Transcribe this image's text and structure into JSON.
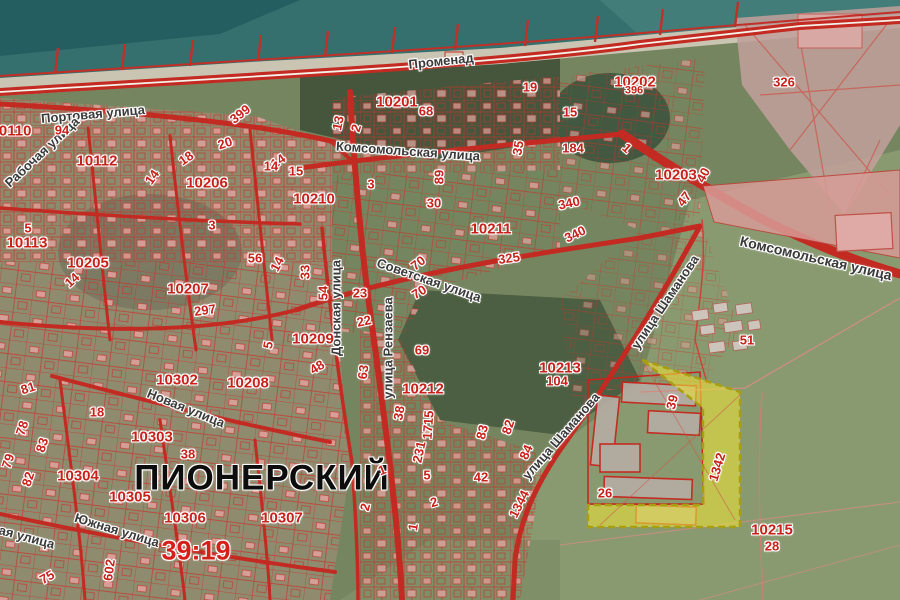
{
  "map": {
    "place": "ПИОНЕРСКИЙ",
    "district": "39:19",
    "place_pos": {
      "x": 262,
      "y": 478
    },
    "district_pos": {
      "x": 196,
      "y": 551
    },
    "colors": {
      "sea": "#35706e",
      "sand": "#cac4b2",
      "land": "#75855f",
      "parcel_lines": "#c8352c",
      "number_text": "#c8201a",
      "street_text": "#3a3a3a",
      "highlight_fill": "#e6df3d",
      "highlight_border": "#a89f10"
    }
  },
  "selected_parcel": {
    "label": "1342",
    "x": 717,
    "y": 467,
    "r": -73
  },
  "streets": [
    {
      "t": "Променад",
      "x": 441,
      "y": 61,
      "r": -6
    },
    {
      "t": "Портовая улица",
      "x": 93,
      "y": 114,
      "r": -5
    },
    {
      "t": "Рабочая улица",
      "x": 42,
      "y": 152,
      "r": -43
    },
    {
      "t": "Комсомольская улица",
      "x": 408,
      "y": 151,
      "r": 4
    },
    {
      "t": "Комсомольская улица",
      "x": 816,
      "y": 258,
      "r": 13,
      "s": 14
    },
    {
      "t": "Советская улица",
      "x": 429,
      "y": 280,
      "r": 19
    },
    {
      "t": "Донская улица",
      "x": 336,
      "y": 308,
      "r": -90
    },
    {
      "t": "улица Рензаева",
      "x": 388,
      "y": 348,
      "r": -90
    },
    {
      "t": "улица Шаманова",
      "x": 665,
      "y": 302,
      "r": -56
    },
    {
      "t": "улица Шаманова",
      "x": 561,
      "y": 436,
      "r": -49
    },
    {
      "t": "Новая улица",
      "x": 186,
      "y": 408,
      "r": 22
    },
    {
      "t": "Южная улица",
      "x": 12,
      "y": 533,
      "r": 15
    },
    {
      "t": "Южная улица",
      "x": 117,
      "y": 530,
      "r": 17
    }
  ],
  "quarters": [
    {
      "t": "10110",
      "x": 11,
      "y": 131
    },
    {
      "t": "10112",
      "x": 97,
      "y": 161
    },
    {
      "t": "10113",
      "x": 27,
      "y": 243
    },
    {
      "t": "10201",
      "x": 397,
      "y": 102
    },
    {
      "t": "10202",
      "x": 635,
      "y": 82
    },
    {
      "t": "10203",
      "x": 676,
      "y": 175
    },
    {
      "t": "10205",
      "x": 88,
      "y": 263
    },
    {
      "t": "10206",
      "x": 207,
      "y": 183
    },
    {
      "t": "10207",
      "x": 188,
      "y": 289
    },
    {
      "t": "10208",
      "x": 248,
      "y": 383
    },
    {
      "t": "10209",
      "x": 313,
      "y": 339
    },
    {
      "t": "10210",
      "x": 314,
      "y": 199
    },
    {
      "t": "10211",
      "x": 491,
      "y": 229
    },
    {
      "t": "10212",
      "x": 423,
      "y": 389
    },
    {
      "t": "10213",
      "x": 560,
      "y": 368
    },
    {
      "t": "10215",
      "x": 772,
      "y": 530
    },
    {
      "t": "10302",
      "x": 177,
      "y": 380
    },
    {
      "t": "10303",
      "x": 152,
      "y": 437
    },
    {
      "t": "10304",
      "x": 78,
      "y": 476
    },
    {
      "t": "10305",
      "x": 130,
      "y": 497
    },
    {
      "t": "10306",
      "x": 185,
      "y": 518
    },
    {
      "t": "10307",
      "x": 282,
      "y": 518
    }
  ],
  "parcels": [
    {
      "t": "94",
      "x": 62,
      "y": 130
    },
    {
      "t": "399",
      "x": 240,
      "y": 114,
      "r": -38
    },
    {
      "t": "20",
      "x": 225,
      "y": 143,
      "r": -18
    },
    {
      "t": "18",
      "x": 186,
      "y": 158,
      "r": -35
    },
    {
      "t": "14",
      "x": 152,
      "y": 177,
      "r": -55
    },
    {
      "t": "14",
      "x": 278,
      "y": 161,
      "r": -35
    },
    {
      "t": "13",
      "x": 338,
      "y": 123,
      "r": -78
    },
    {
      "t": "2",
      "x": 356,
      "y": 128,
      "r": -72
    },
    {
      "t": "14",
      "x": 271,
      "y": 166
    },
    {
      "t": "15",
      "x": 296,
      "y": 171
    },
    {
      "t": "3",
      "x": 371,
      "y": 184
    },
    {
      "t": "68",
      "x": 426,
      "y": 111
    },
    {
      "t": "19",
      "x": 530,
      "y": 87
    },
    {
      "t": "15",
      "x": 570,
      "y": 112
    },
    {
      "t": "35",
      "x": 518,
      "y": 148,
      "r": -80
    },
    {
      "t": "184",
      "x": 573,
      "y": 148
    },
    {
      "t": "396",
      "x": 634,
      "y": 91,
      "s": 11
    },
    {
      "t": "326",
      "x": 784,
      "y": 82
    },
    {
      "t": "1",
      "x": 627,
      "y": 148,
      "r": 42
    },
    {
      "t": "40",
      "x": 703,
      "y": 175,
      "r": -62
    },
    {
      "t": "47",
      "x": 684,
      "y": 199,
      "r": -52
    },
    {
      "t": "5",
      "x": 28,
      "y": 228
    },
    {
      "t": "14",
      "x": 72,
      "y": 280,
      "r": -42
    },
    {
      "t": "3",
      "x": 212,
      "y": 225
    },
    {
      "t": "56",
      "x": 255,
      "y": 258
    },
    {
      "t": "14",
      "x": 277,
      "y": 264,
      "r": -62
    },
    {
      "t": "89",
      "x": 439,
      "y": 177,
      "r": -90
    },
    {
      "t": "30",
      "x": 434,
      "y": 203
    },
    {
      "t": "340",
      "x": 569,
      "y": 203,
      "r": -12
    },
    {
      "t": "340",
      "x": 575,
      "y": 234,
      "r": -26
    },
    {
      "t": "325",
      "x": 509,
      "y": 258,
      "r": -8
    },
    {
      "t": "33",
      "x": 305,
      "y": 272,
      "r": -90
    },
    {
      "t": "54",
      "x": 323,
      "y": 293,
      "r": -90
    },
    {
      "t": "23",
      "x": 360,
      "y": 293
    },
    {
      "t": "22",
      "x": 364,
      "y": 321,
      "r": -12
    },
    {
      "t": "70",
      "x": 418,
      "y": 263,
      "r": -38
    },
    {
      "t": "70",
      "x": 419,
      "y": 292,
      "r": -32
    },
    {
      "t": "297",
      "x": 205,
      "y": 310,
      "r": -8
    },
    {
      "t": "5",
      "x": 268,
      "y": 345,
      "r": -78
    },
    {
      "t": "48",
      "x": 317,
      "y": 367,
      "r": -32
    },
    {
      "t": "63",
      "x": 363,
      "y": 372,
      "r": -82
    },
    {
      "t": "69",
      "x": 422,
      "y": 350
    },
    {
      "t": "104",
      "x": 557,
      "y": 381
    },
    {
      "t": "81",
      "x": 28,
      "y": 388,
      "r": -18
    },
    {
      "t": "18",
      "x": 97,
      "y": 412
    },
    {
      "t": "78",
      "x": 22,
      "y": 428,
      "r": -72
    },
    {
      "t": "83",
      "x": 42,
      "y": 445,
      "r": -72
    },
    {
      "t": "79",
      "x": 8,
      "y": 461,
      "r": -72
    },
    {
      "t": "82",
      "x": 28,
      "y": 479,
      "r": -72
    },
    {
      "t": "38",
      "x": 188,
      "y": 454
    },
    {
      "t": "38",
      "x": 399,
      "y": 413,
      "r": -80
    },
    {
      "t": "1715",
      "x": 428,
      "y": 425,
      "r": -86
    },
    {
      "t": "231",
      "x": 419,
      "y": 452,
      "r": -78
    },
    {
      "t": "83",
      "x": 482,
      "y": 432,
      "r": -76
    },
    {
      "t": "82",
      "x": 508,
      "y": 427,
      "r": -72
    },
    {
      "t": "84",
      "x": 526,
      "y": 452,
      "r": -66
    },
    {
      "t": "42",
      "x": 481,
      "y": 477
    },
    {
      "t": "1",
      "x": 382,
      "y": 470,
      "r": -22
    },
    {
      "t": "5",
      "x": 427,
      "y": 475
    },
    {
      "t": "2",
      "x": 434,
      "y": 502,
      "r": -16
    },
    {
      "t": "2",
      "x": 365,
      "y": 507,
      "r": -76
    },
    {
      "t": "1",
      "x": 413,
      "y": 527,
      "r": -80
    },
    {
      "t": "1344",
      "x": 519,
      "y": 504,
      "r": -63
    },
    {
      "t": "26",
      "x": 605,
      "y": 493
    },
    {
      "t": "51",
      "x": 747,
      "y": 340
    },
    {
      "t": "39",
      "x": 672,
      "y": 402,
      "r": -76
    },
    {
      "t": "28",
      "x": 772,
      "y": 546
    },
    {
      "t": "602",
      "x": 109,
      "y": 570,
      "r": -82
    },
    {
      "t": "75",
      "x": 47,
      "y": 577,
      "r": -30
    },
    {
      "t": "1342",
      "x": 717,
      "y": 467,
      "r": -73
    }
  ]
}
